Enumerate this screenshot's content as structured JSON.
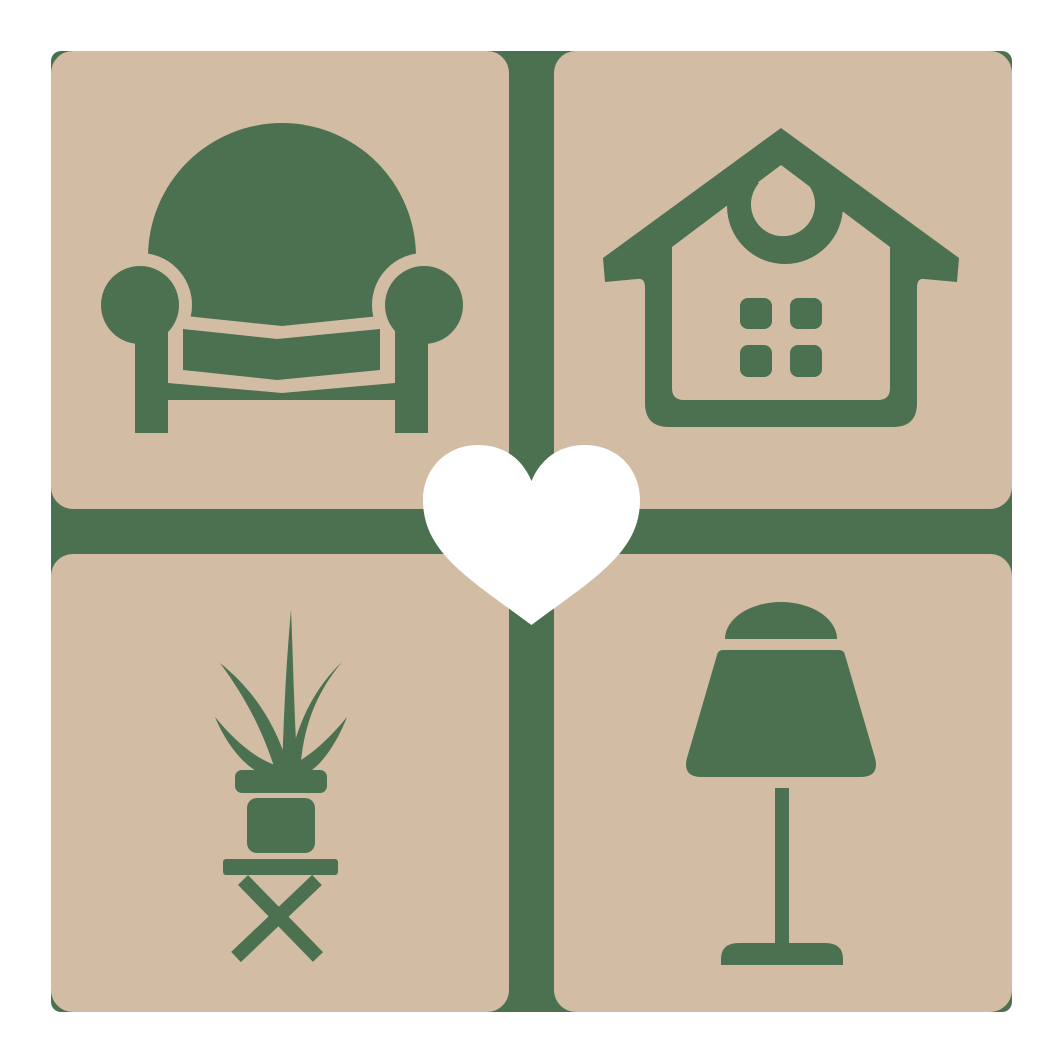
{
  "logo": {
    "name": "home-furnishings-love-logo",
    "description": "Four rounded tiles with furniture icons separated by a green cross, white heart in the center",
    "colors": {
      "background": "#ffffff",
      "tile": "#d3bca4",
      "accent": "#4b7150",
      "heart": "#ffffff"
    },
    "tiles": [
      {
        "position": "top-left",
        "icon": "armchair-icon",
        "label": "armchair"
      },
      {
        "position": "top-right",
        "icon": "house-icon",
        "label": "house with crescent ornament and four window panes"
      },
      {
        "position": "bottom-left",
        "icon": "potted-plant-icon",
        "label": "spiky potted plant on cross-leg stool"
      },
      {
        "position": "bottom-right",
        "icon": "table-lamp-icon",
        "label": "table lamp"
      }
    ],
    "center": {
      "icon": "heart-icon",
      "label": "heart"
    }
  }
}
